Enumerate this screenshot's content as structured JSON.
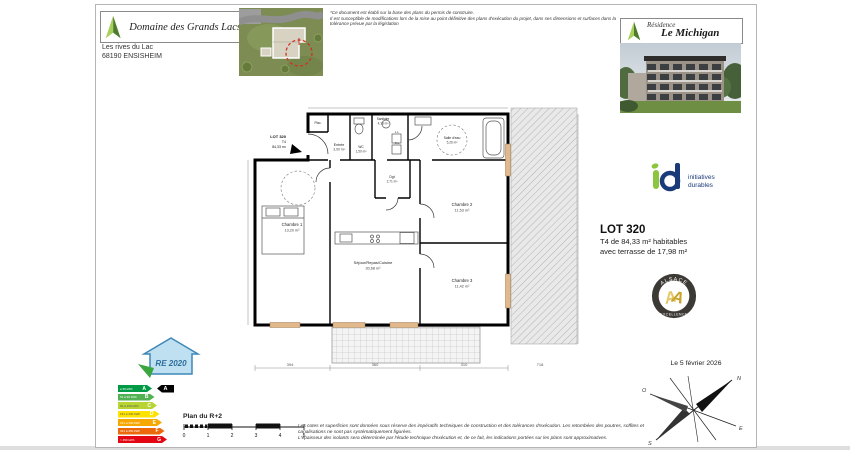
{
  "developer": {
    "name": "Domaine des Grands Lacs",
    "address1": "Les rives du Lac",
    "address2": "68190 ENSISHEIM"
  },
  "residence": {
    "label": "Résidence",
    "name": "Le Michigan"
  },
  "top_disclaimer": {
    "line1": "*Ce document est établi sur la base des plans du permis de construire.",
    "line2": "Il est susceptible de modifications lors de la mise au point définitive des plans d'exécution du projet, dans ses dimensions et surfaces dans la tolérance prévue par la législation"
  },
  "footer_disclaimer": {
    "line1": "Les cotes et superficies sont données sous réserve des impératifs techniques de construction et des tolérances d'exécution. Les retombées des poutres, soffites et canalisations ne sont pas systématiquement figurées.",
    "line2": "L'épaisseur des isolants sera déterminée par l'étude technique d'exécution et, de ce fait, les indications portées sur les plans sont approximatives."
  },
  "lot": {
    "title": "LOT 320",
    "line1": "T4 de 84,33 m² habitables",
    "line2": "avec  terrasse de 17,98 m²"
  },
  "id_logo": {
    "line1": "initiatives",
    "line2": "durables",
    "green": "#8cc63e",
    "blue": "#1b3a7a"
  },
  "alsace_badge": {
    "top": "ALSACE",
    "bottom": "EXCELLENCE"
  },
  "date_text": "Le 5 février 2026",
  "plan_level": "Plan du R+2",
  "scale_ticks": [
    "0",
    "1",
    "2",
    "3",
    "4",
    "5"
  ],
  "compass": {
    "n": "N",
    "s": "S",
    "e": "E",
    "o": "O"
  },
  "energy": {
    "house_text": "RE 2020",
    "selected": "A",
    "classes": [
      {
        "letter": "A",
        "range": "≤ 50 kWh"
      },
      {
        "letter": "B",
        "range": "51 à 90 kWh"
      },
      {
        "letter": "C",
        "range": "91 à 150 kWh"
      },
      {
        "letter": "D",
        "range": "151 à 230 kWh"
      },
      {
        "letter": "E",
        "range": "231 à 330 kWh"
      },
      {
        "letter": "F",
        "range": "331 à 450 kWh"
      },
      {
        "letter": "G",
        "range": "> 450 kWh"
      }
    ],
    "colors": [
      "#009a44",
      "#52b153",
      "#b8d432",
      "#ffe300",
      "#f6a800",
      "#eb690b",
      "#e30613"
    ]
  },
  "plan": {
    "lot_tag": {
      "l1": "LOT 320",
      "l2": "T4",
      "l3": "84,33 m²"
    },
    "rooms": [
      {
        "name": "Chambre 1",
        "area": "13,20 m²"
      },
      {
        "name": "Séjour/Repas/Cuisine",
        "area": "30,68 m²"
      },
      {
        "name": "Chambre 2",
        "area": "11,53 m²"
      },
      {
        "name": "Chambre 3",
        "area": "11,42 m²"
      },
      {
        "name": "Entrée",
        "area": "3,90 m²"
      },
      {
        "name": "WC",
        "area": "1,50 m²"
      },
      {
        "name": "Sanitaire",
        "area": "4,13 m²"
      },
      {
        "name": "Dgt",
        "area": "2,71 m²"
      },
      {
        "name": "Salle d'eau",
        "area": "5,26 m²"
      },
      {
        "name": "Plac.",
        "area": ""
      }
    ],
    "appliances": {
      "ll": "L.L",
      "sl": "S.L"
    },
    "dims": {
      "d1": "394",
      "d2": "360",
      "d3": "310",
      "d4": "718",
      "terrace": "723"
    }
  }
}
